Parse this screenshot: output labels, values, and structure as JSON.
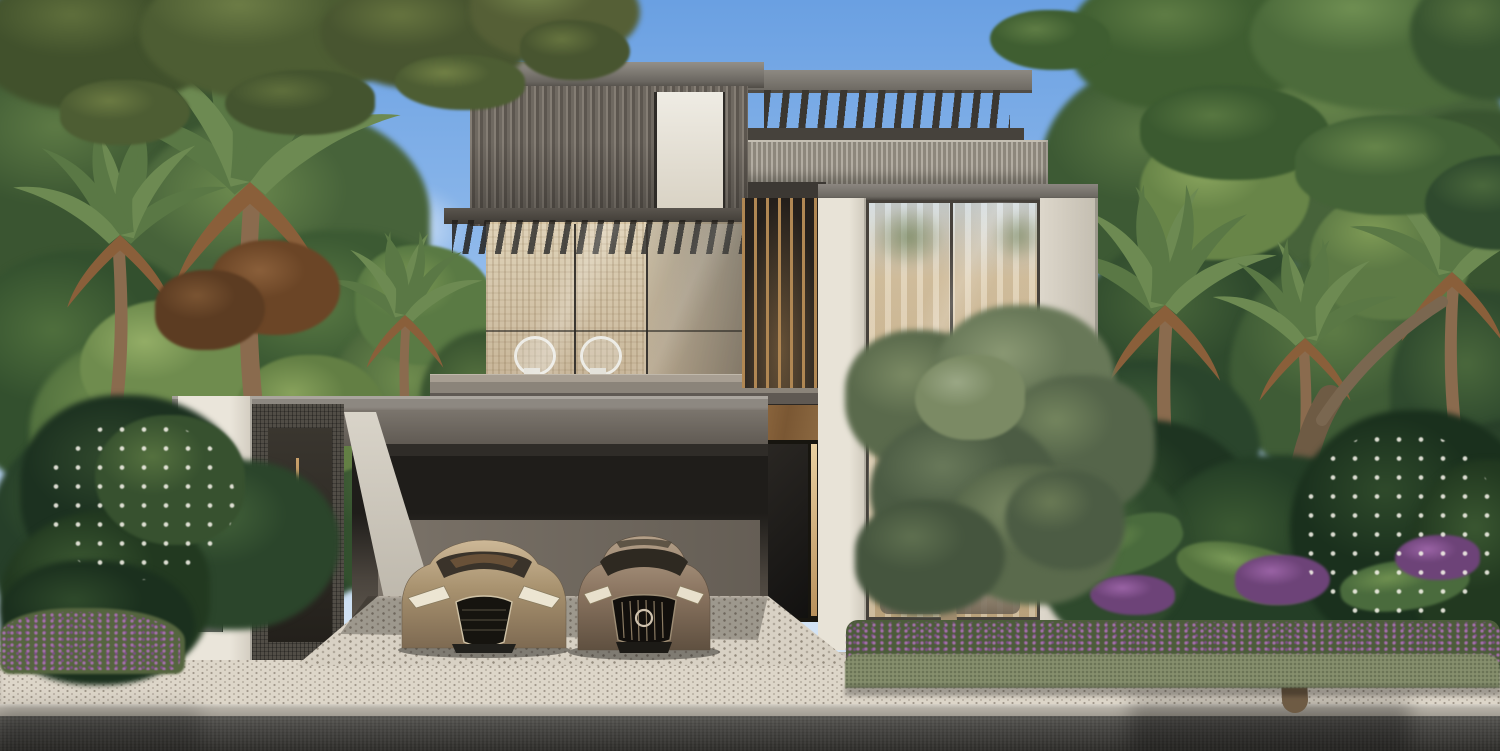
{
  "scene": {
    "type": "architectural exterior rendering",
    "description": "Modern three-storey luxury villa in daylight with rooftop pergola, glass facade, double carport with two luxury cars, tropical landscaping with palms, frangipani and purple flower beds, paved driveway, sidewalk and asphalt road",
    "time_of_day": "day",
    "cars_count": 2,
    "birds_visible": true
  },
  "signage": {
    "plate_text": "01"
  },
  "palette": {
    "sky_top": "#6aa0e2",
    "sky_mid": "#8ab6ea",
    "sky_horizon": "#e2ecf5",
    "cloud": "#ffffff",
    "stone": "#e2dcd0",
    "slat_cladding": "#6e6760",
    "parapet": "#a59f94",
    "bronze": "#b08753",
    "glass_curtain": "#d6c3a2",
    "glass_frame": "#46413b",
    "door": "#1b1815",
    "canopy": "#6f6a62",
    "carport_interior": "#6e675e",
    "paver": "#d8d1c4",
    "sidewalk": "#ddd6c9",
    "road": "#3a3936",
    "curb": "#b5b0a6",
    "grass": "#7c9c48",
    "foliage_dark": "#33502e",
    "foliage_mid": "#5d7a45",
    "foliage_light": "#8aa55e",
    "palm_green": "#5a7845",
    "palm_dry": "#8a5f3a",
    "olive_leaf": "#7b8a64",
    "purple_flower": "#9a63a5",
    "white_flower": "#f2f0e6",
    "trunk": "#7a6750",
    "car_champagne": "#b3a084",
    "car_bronze": "#a18c74",
    "plate_metal": "#8f908e",
    "plate_text": "#e6e6e4"
  }
}
